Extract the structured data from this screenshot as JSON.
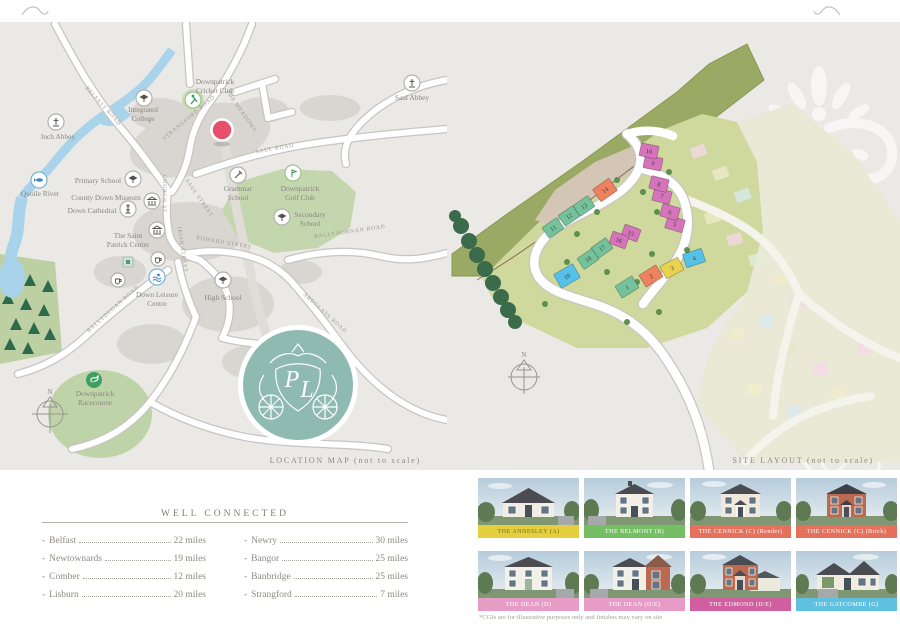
{
  "page": {
    "captions": {
      "location_map": "LOCATION MAP (not to scale)",
      "site_layout": "SITE LAYOUT (not to scale)"
    }
  },
  "location_map": {
    "compass": "N",
    "marker_color": "#e6506d",
    "logo_teal": "#8fbab2",
    "monogram": {
      "p": "P",
      "l": "L"
    },
    "landmarks": [
      {
        "icon": "abbey-icon",
        "lines": [
          "Inch Abbey"
        ]
      },
      {
        "icon": "school-icon",
        "lines": [
          "Integrated",
          "College"
        ]
      },
      {
        "icon": "cricket-icon",
        "lines": [
          "Downpatrick",
          "Cricket Club"
        ]
      },
      {
        "icon": "abbey-icon",
        "lines": [
          "Saul Abbey"
        ]
      },
      {
        "icon": "fish-icon",
        "lines": [
          "Quoile River"
        ]
      },
      {
        "icon": "school-icon",
        "lines": [
          "Primary School"
        ]
      },
      {
        "icon": "museum-icon",
        "lines": [
          "County Down Museum"
        ]
      },
      {
        "icon": "cathedral-icon",
        "lines": [
          "Down Cathedral"
        ]
      },
      {
        "icon": "heritage-icon",
        "lines": [
          "The Saint",
          "Patrick Centre"
        ]
      },
      {
        "icon": "school-icon",
        "lines": [
          "Grammar",
          "School"
        ]
      },
      {
        "icon": "golf-icon",
        "lines": [
          "Downpatrick",
          "Golf Club"
        ]
      },
      {
        "icon": "school-icon",
        "lines": [
          "Secondary",
          "School"
        ]
      },
      {
        "icon": "swim-icon",
        "lines": [
          "Down Leisure",
          "Centre"
        ]
      },
      {
        "icon": "school-icon",
        "lines": [
          "High School"
        ]
      },
      {
        "icon": "horse-icon",
        "lines": [
          "Downpatrick",
          "Racecourse"
        ]
      }
    ],
    "roads": [
      {
        "name": "BELFAST ROAD"
      },
      {
        "name": "STRANGFORD ROAD"
      },
      {
        "name": "SAUL ROAD"
      },
      {
        "name": "THE MEADOWS"
      },
      {
        "name": "CHURCH ST"
      },
      {
        "name": "SAUL STREET"
      },
      {
        "name": "EDWARD STREET"
      },
      {
        "name": "IRISH STREET"
      },
      {
        "name": "BALLYDUGAN ROAD"
      },
      {
        "name": "BALLYHORNAN ROAD"
      },
      {
        "name": "ARDGLASS ROAD"
      }
    ]
  },
  "site_layout": {
    "compass": "N",
    "plots": [
      {
        "number": "1",
        "color": "#74c29c"
      },
      {
        "number": "2",
        "color": "#ee8160"
      },
      {
        "number": "3",
        "color": "#e8d24e"
      },
      {
        "number": "4",
        "color": "#55c1e9"
      },
      {
        "number": "5",
        "color": "#d573bb"
      },
      {
        "number": "6",
        "color": "#d573bb"
      },
      {
        "number": "7",
        "color": "#d573bb"
      },
      {
        "number": "8",
        "color": "#d573bb"
      },
      {
        "number": "9",
        "color": "#d573bb"
      },
      {
        "number": "10",
        "color": "#d573bb"
      },
      {
        "number": "11",
        "color": "#74c29c"
      },
      {
        "number": "12",
        "color": "#74c29c"
      },
      {
        "number": "13",
        "color": "#74c29c"
      },
      {
        "number": "14",
        "color": "#ee8160"
      },
      {
        "number": "15",
        "color": "#d573bb"
      },
      {
        "number": "16",
        "color": "#d573bb"
      },
      {
        "number": "17",
        "color": "#74c29c"
      },
      {
        "number": "18",
        "color": "#74c29c"
      },
      {
        "number": "19",
        "color": "#55c1e9"
      }
    ]
  },
  "well_connected": {
    "title": "WELL CONNECTED",
    "bullet": "-",
    "left": [
      {
        "place": "Belfast",
        "distance": "22 miles"
      },
      {
        "place": "Newtownards",
        "distance": "19 miles"
      },
      {
        "place": "Comber",
        "distance": "12 miles"
      },
      {
        "place": "Lisburn",
        "distance": "20 miles"
      }
    ],
    "right": [
      {
        "place": "Newry",
        "distance": "30 miles"
      },
      {
        "place": "Bangor",
        "distance": "25 miles"
      },
      {
        "place": "Banbridge",
        "distance": "25 miles"
      },
      {
        "place": "Strangford",
        "distance": "7 miles"
      }
    ]
  },
  "house_types": {
    "disclaimer": "*CGIs are for illustrative purposes only and finishes may vary on site",
    "cards": [
      {
        "label": "THE ANNESLEY (A)",
        "bar_bg": "#e5cf3f",
        "bar_text": "#756d1f",
        "wall": "#f2ede3"
      },
      {
        "label": "THE BELMONT (B)",
        "bar_bg": "#74bf63",
        "bar_text": "#ffffff",
        "wall": "#f3efe6"
      },
      {
        "label": "THE CENNICK (C) (Render)",
        "bar_bg": "#e5705b",
        "bar_text": "#ffffff",
        "wall": "#f0e8d8"
      },
      {
        "label": "THE CENNICK (C) (Brick)",
        "bar_bg": "#e5705b",
        "bar_text": "#ffffff",
        "wall": "#b96a50"
      },
      {
        "label": "THE DEAN (D)",
        "bar_bg": "#e79cc6",
        "bar_text": "#ffffff",
        "wall": "#f3f0e9"
      },
      {
        "label": "THE DEAN (D/E)",
        "bar_bg": "#e79cc6",
        "bar_text": "#ffffff",
        "wall": "#f2efe6"
      },
      {
        "label": "THE EDMOND (D/E)",
        "bar_bg": "#d05f9f",
        "bar_text": "#ffffff",
        "wall": "#bb6a4e"
      },
      {
        "label": "THE GATCOMBE (G)",
        "bar_bg": "#5fc0e0",
        "bar_text": "#ffffff",
        "wall": "#f2ece0"
      }
    ]
  }
}
